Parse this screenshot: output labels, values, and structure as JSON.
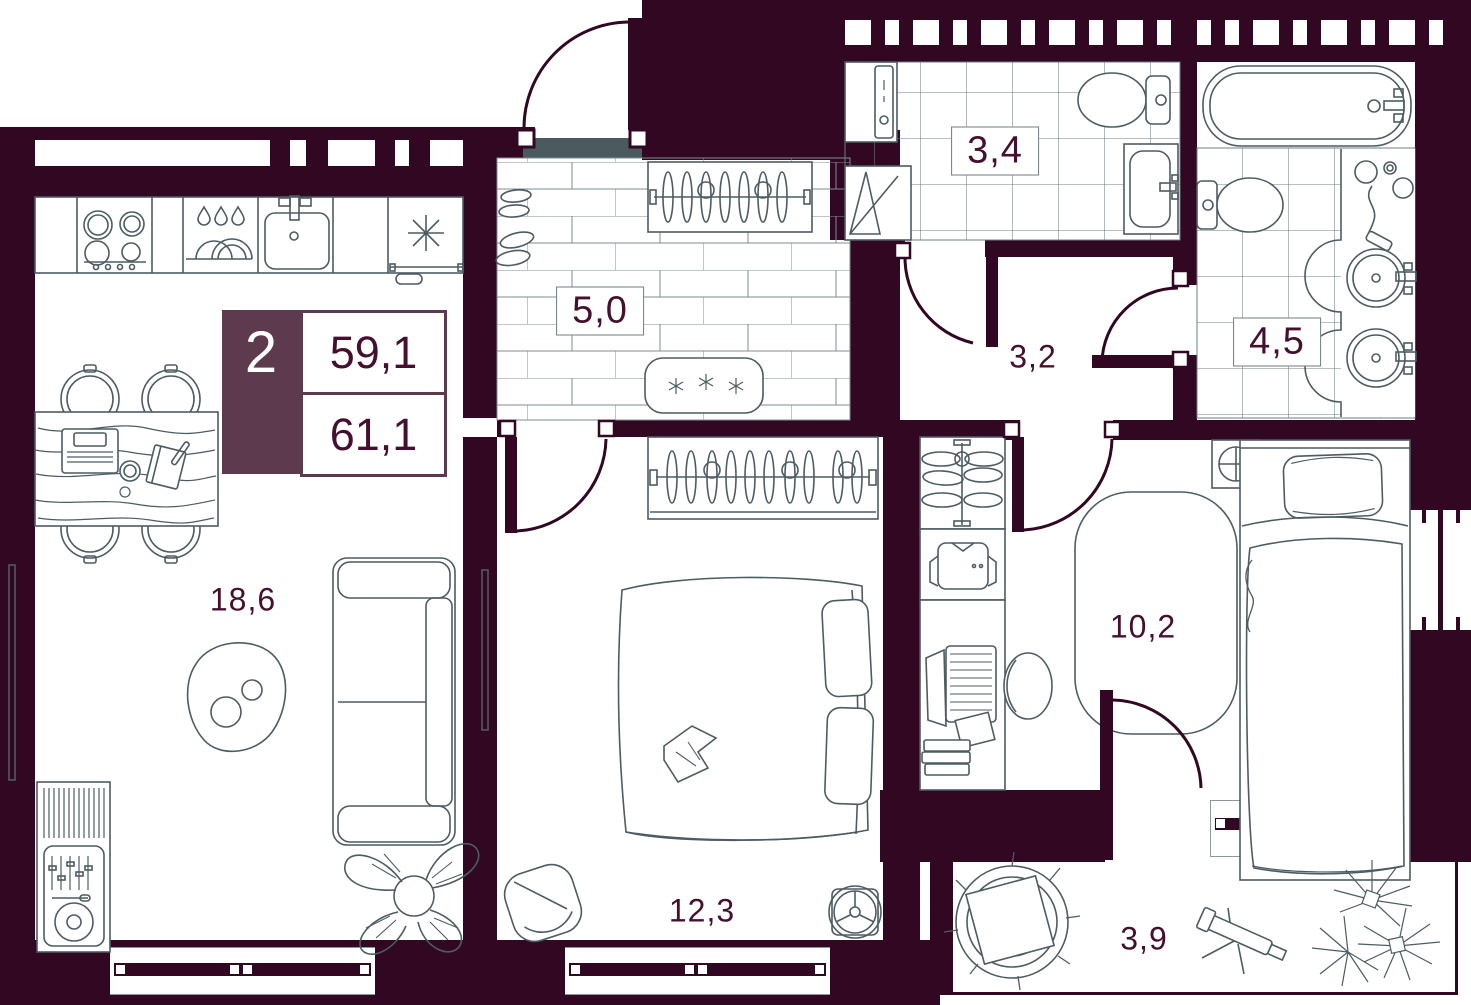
{
  "legend": {
    "rooms_count": "2",
    "living_area": "59,1",
    "total_area": "61,1"
  },
  "rooms": {
    "living_kitchen": {
      "area": "18,6"
    },
    "hallway": {
      "area": "5,0"
    },
    "bathroom": {
      "area": "3,4"
    },
    "corridor": {
      "area": "3,2"
    },
    "bathroom_2": {
      "area": "4,5"
    },
    "bedroom_2": {
      "area": "10,2"
    },
    "bedroom_1": {
      "area": "12,3"
    },
    "balcony": {
      "area": "3,9"
    }
  },
  "colors": {
    "wall": "#310722",
    "accent": "#5d3a4d",
    "furniture_line": "#4d5c63",
    "label_text": "#45102e",
    "threshold": "#4b5a5e",
    "tile_line": "#6e7e84"
  }
}
